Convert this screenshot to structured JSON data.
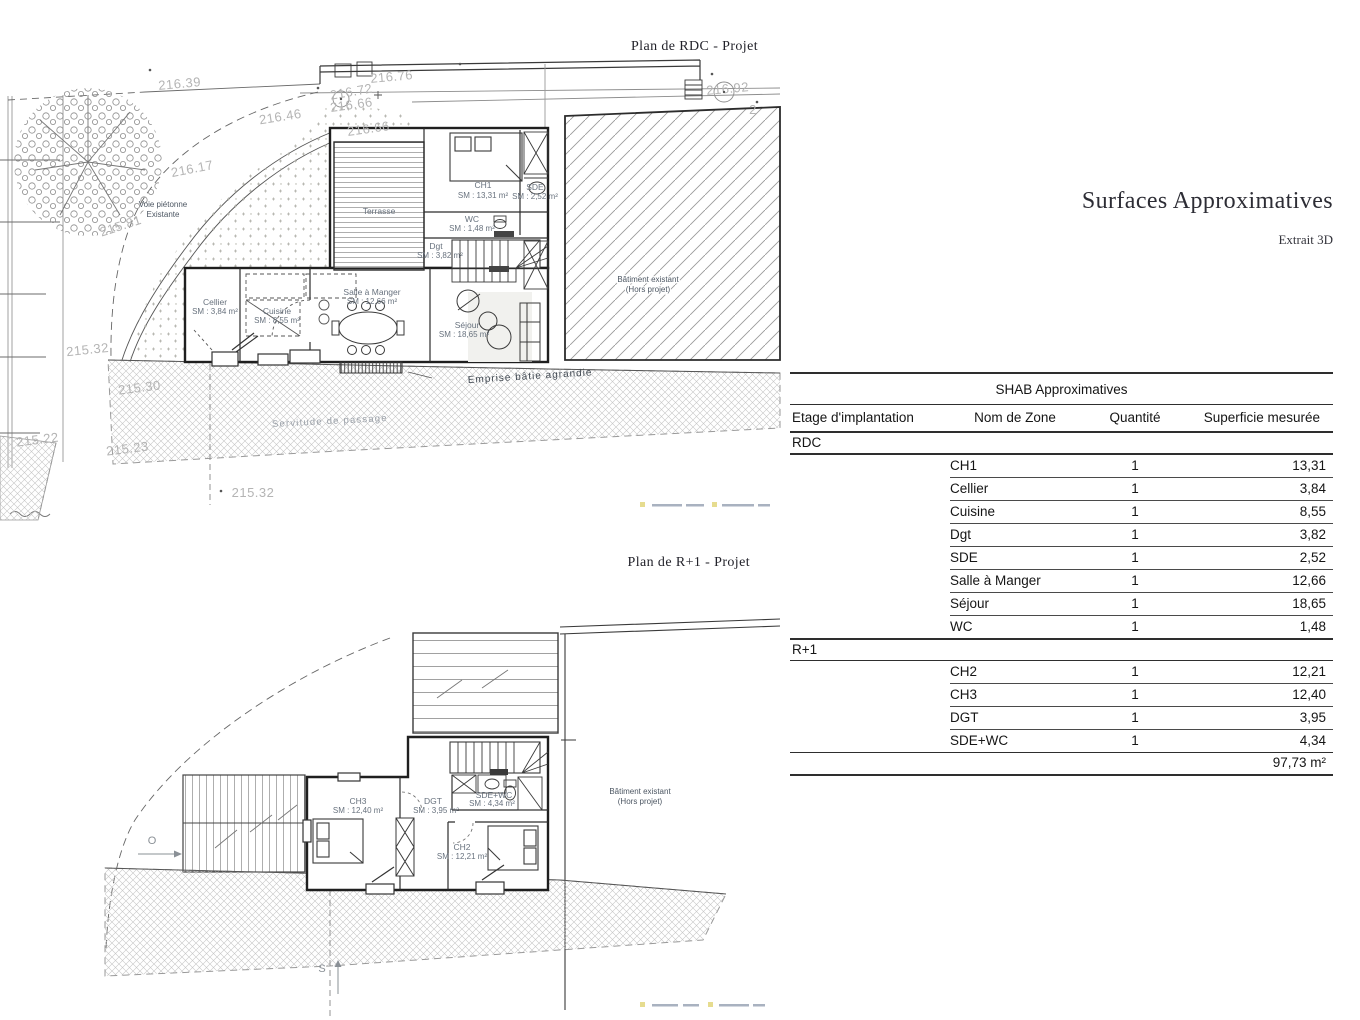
{
  "rdc": {
    "title": "Plan de RDC - Projet",
    "rooms": {
      "terrasse": {
        "name": "Terrasse"
      },
      "ch1": {
        "name": "CH1",
        "area": "SM : 13,31 m²"
      },
      "sde": {
        "name": "SDE",
        "area": "SM : 2,52 m²"
      },
      "wc": {
        "name": "WC",
        "area": "SM : 1,48 m²"
      },
      "dgt": {
        "name": "Dgt",
        "area": "SM : 3,82 m²"
      },
      "sam": {
        "name": "Salle à Manger",
        "area": "SM : 12,66 m²"
      },
      "cuisine": {
        "name": "Cuisine",
        "area": "SM : 8,55 m²"
      },
      "cellier": {
        "name": "Cellier",
        "area": "SM : 3,84 m²"
      },
      "sejour": {
        "name": "Séjour",
        "area": "SM : 18,65 m²"
      }
    },
    "existing_building": {
      "line1": "Bâtiment existant",
      "line2": "(Hors projet)"
    },
    "annotations": {
      "voie1": "Voie piétonne",
      "voie2": "Existante",
      "servitude": "Servitude de passage",
      "emprise": "Emprise bâtie agrandie"
    },
    "elevations": {
      "e21639": "216.39",
      "e21672": "216.72",
      "e21676": "216.76",
      "e21666a": "216.66",
      "e21646": "216.46",
      "e21666b": "216.66",
      "e21617": "216.17",
      "e21581": "215.81",
      "e21532a": "215.32",
      "e21530": "215.30",
      "e21522": "215.22",
      "e21523": "215.23",
      "e21532b": "215.32",
      "e21692": "216.92",
      "e2": "2"
    }
  },
  "r1": {
    "title": "Plan de R+1 - Projet",
    "rooms": {
      "ch3": {
        "name": "CH3",
        "area": "SM : 12,40 m²"
      },
      "dgt": {
        "name": "DGT",
        "area": "SM : 3,95 m²"
      },
      "sdewc": {
        "name": "SDE+WC",
        "area": "SM : 4,34 m²"
      },
      "ch2": {
        "name": "CH2",
        "area": "SM : 12,21 m²"
      }
    },
    "existing_building": {
      "line1": "Bâtiment existant",
      "line2": "(Hors projet)"
    },
    "orientation": {
      "west": "O",
      "south": "S"
    }
  },
  "panel": {
    "title": "Surfaces Approximatives",
    "subtitle": "Extrait 3D"
  },
  "table": {
    "title": "SHAB Approximatives",
    "headers": [
      "Etage d'implantation",
      "Nom de Zone",
      "Quantité",
      "Superficie mesurée"
    ],
    "sections": [
      {
        "floor": "RDC",
        "rows": [
          [
            "CH1",
            "1",
            "13,31"
          ],
          [
            "Cellier",
            "1",
            "3,84"
          ],
          [
            "Cuisine",
            "1",
            "8,55"
          ],
          [
            "Dgt",
            "1",
            "3,82"
          ],
          [
            "SDE",
            "1",
            "2,52"
          ],
          [
            "Salle à Manger",
            "1",
            "12,66"
          ],
          [
            "Séjour",
            "1",
            "18,65"
          ],
          [
            "WC",
            "1",
            "1,48"
          ]
        ]
      },
      {
        "floor": "R+1",
        "rows": [
          [
            "CH2",
            "1",
            "12,21"
          ],
          [
            "CH3",
            "1",
            "12,40"
          ],
          [
            "DGT",
            "1",
            "3,95"
          ],
          [
            "SDE+WC",
            "1",
            "4,34"
          ]
        ]
      }
    ],
    "total": "97,73 m²"
  }
}
